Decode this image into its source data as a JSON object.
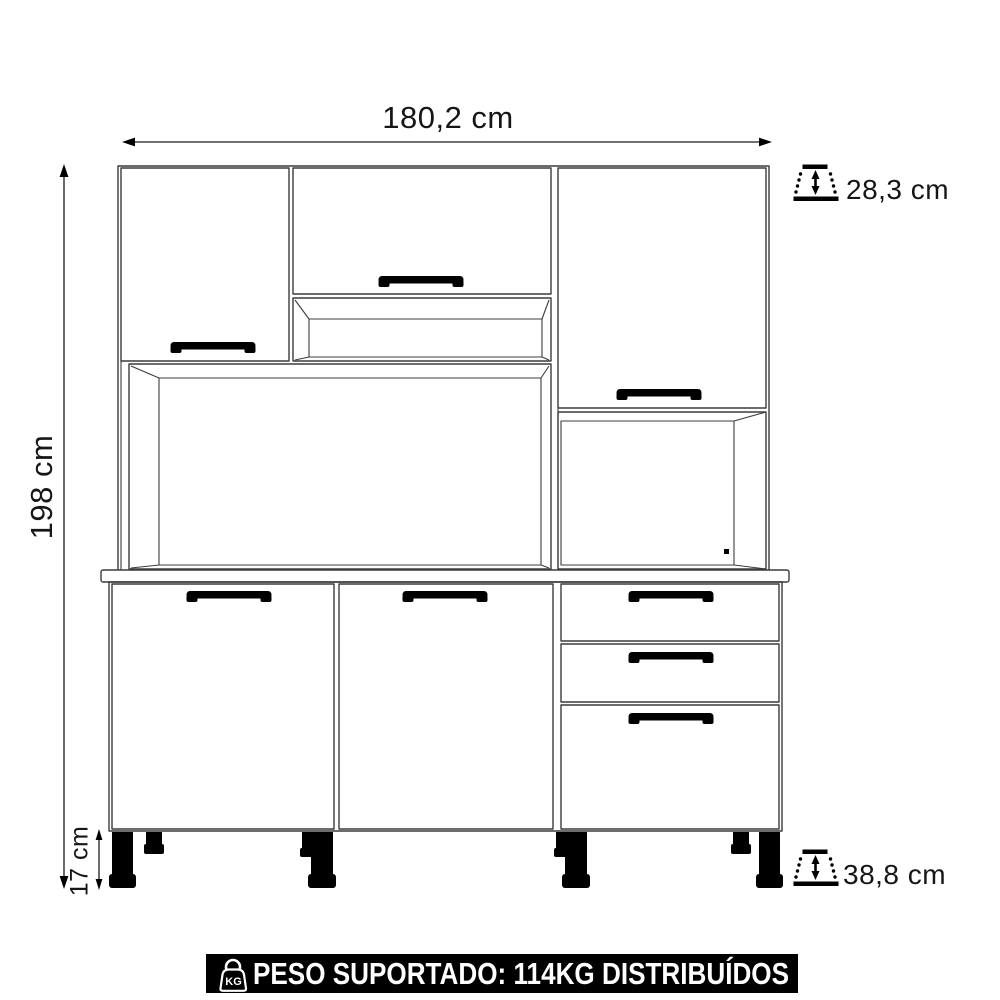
{
  "dimensions": {
    "width": "180,2 cm",
    "height": "198 cm",
    "upper_depth": "28,3 cm",
    "base_depth": "38,8 cm",
    "feet_height": "17 cm"
  },
  "values": {
    "width_cm": 180.2,
    "height_cm": 198,
    "upper_cabinet_depth_cm": 28.3,
    "base_cabinet_depth_cm": 38.8,
    "feet_height_cm": 17,
    "supported_weight_kg": 114
  },
  "banner": {
    "text": "PESO SUPORTADO: 114KG DISTRIBUÍDOS",
    "icon_label": "KG"
  },
  "colors": {
    "background": "#ffffff",
    "line": "#3c3c3c",
    "dimension_text": "#161616",
    "handles_and_legs": "#000000",
    "banner_bg": "#000000",
    "banner_fg": "#ffffff"
  }
}
